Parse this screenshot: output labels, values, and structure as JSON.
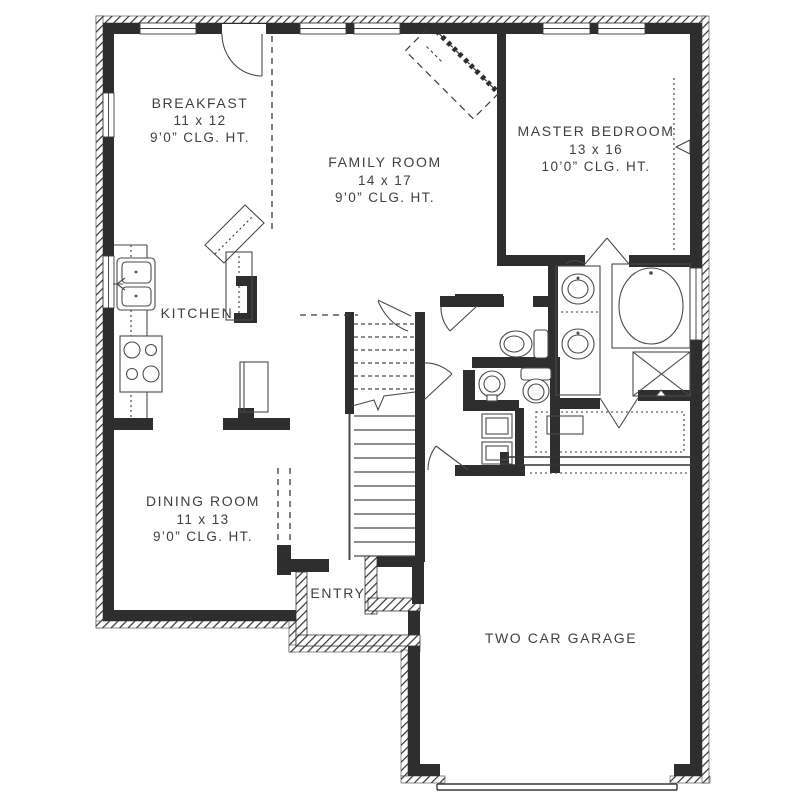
{
  "plan": {
    "title": "First floor plan",
    "rooms": [
      {
        "id": "breakfast",
        "name": "BREAKFAST",
        "dims": "11 x 12",
        "ceiling": "9’0” CLG. HT."
      },
      {
        "id": "family-room",
        "name": "FAMILY ROOM",
        "dims": "14 x 17",
        "ceiling": "9’0” CLG. HT."
      },
      {
        "id": "master-bedroom",
        "name": "MASTER BEDROOM",
        "dims": "13 x 16",
        "ceiling": "10’0” CLG. HT."
      },
      {
        "id": "kitchen",
        "name": "KITCHEN"
      },
      {
        "id": "dining-room",
        "name": "DINING ROOM",
        "dims": "11 x 13",
        "ceiling": "9’0” CLG. HT."
      },
      {
        "id": "entry",
        "name": "ENTRY"
      },
      {
        "id": "garage",
        "name": "TWO CAR GARAGE"
      }
    ],
    "colors": {
      "wall": "#2e2e2e",
      "text": "#3f3f3f",
      "fixture_line": "#4a4a4a",
      "background": "#ffffff"
    }
  }
}
